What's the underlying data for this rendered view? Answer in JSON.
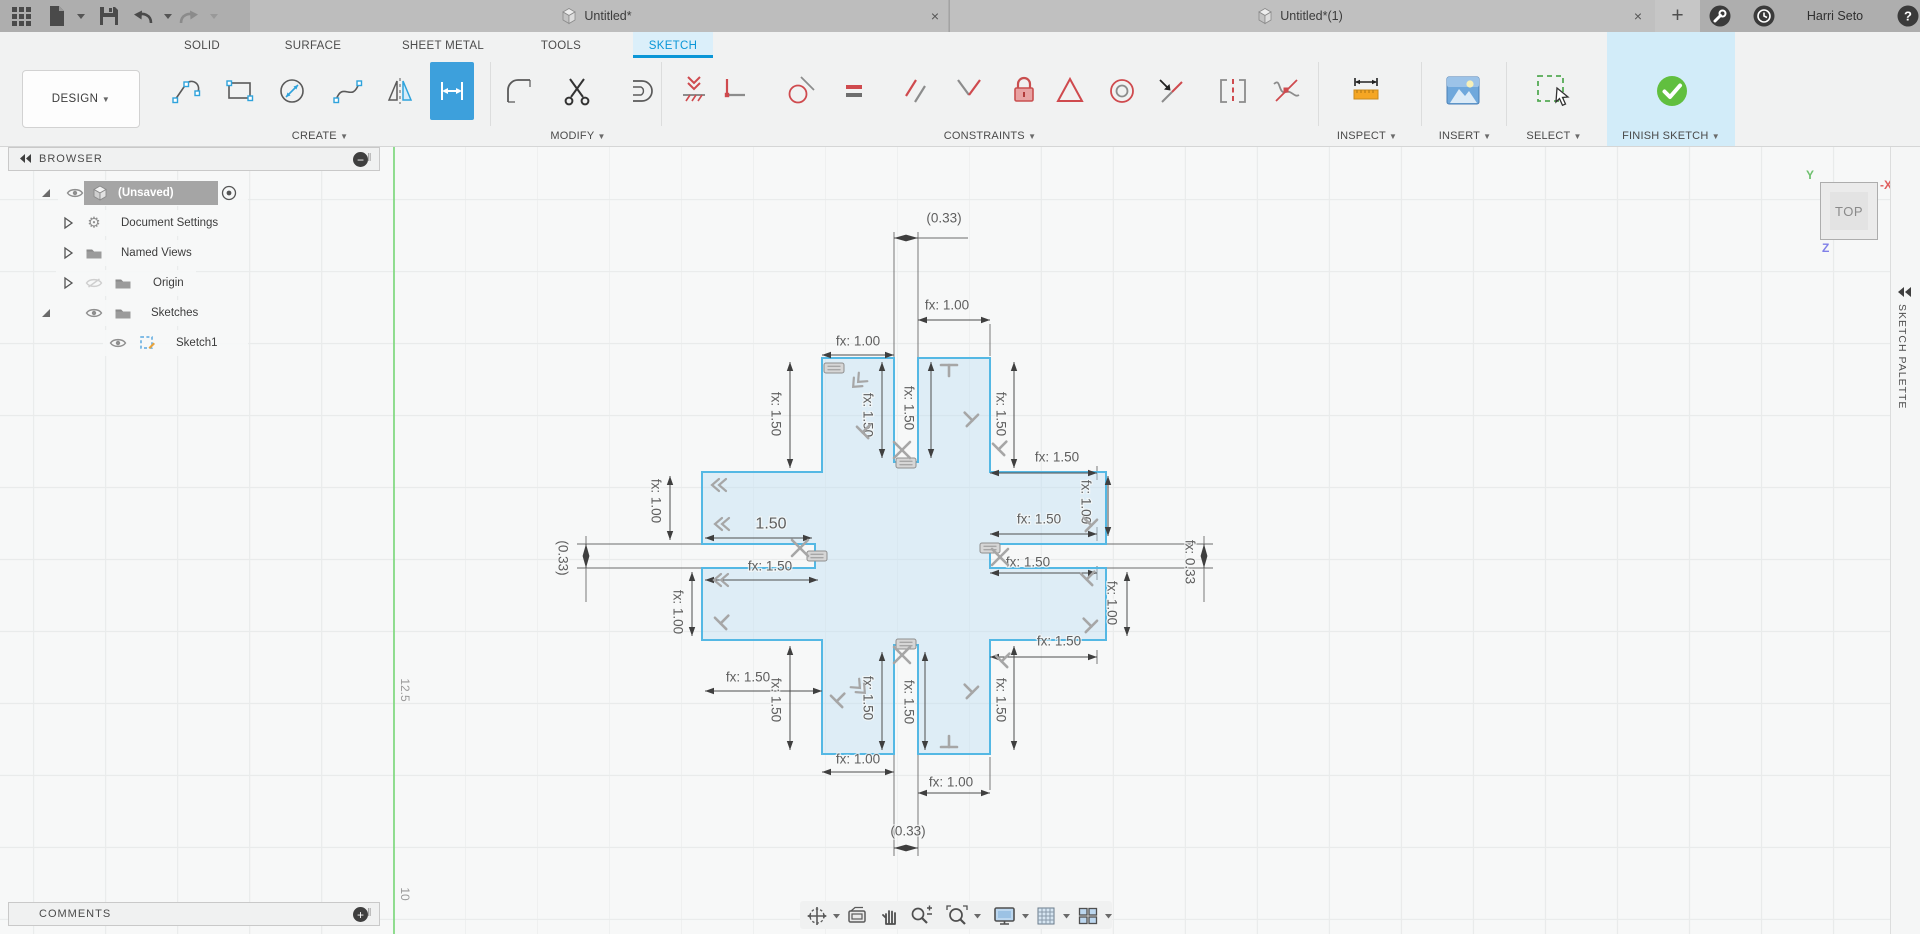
{
  "titlebar": {
    "tabs": [
      {
        "title": "Untitled*"
      },
      {
        "title": "Untitled*(1)"
      }
    ],
    "user": "Harri Seto",
    "actions": [
      "app-grid",
      "new-file",
      "save",
      "undo",
      "redo"
    ]
  },
  "ribbon": {
    "context_label": "DESIGN",
    "tabs": [
      "SOLID",
      "SURFACE",
      "SHEET METAL",
      "TOOLS",
      "SKETCH"
    ],
    "active_tab": "SKETCH",
    "groups": [
      {
        "label": "CREATE",
        "tools": [
          "line",
          "rectangle",
          "circle",
          "spline",
          "mirror",
          "sketch-dimension"
        ]
      },
      {
        "label": "MODIFY",
        "tools": [
          "fillet",
          "trim",
          "offset"
        ]
      },
      {
        "label": "CONSTRAINTS",
        "tools": [
          "coincident",
          "horizontal-vertical",
          "tangent",
          "equal",
          "parallel",
          "perpendicular",
          "fix-unfix",
          "symmetry",
          "concentric",
          "midpoint",
          "collinear",
          "curvature"
        ]
      },
      {
        "label": "INSPECT",
        "tools": [
          "measure"
        ]
      },
      {
        "label": "INSERT",
        "tools": [
          "insert-image"
        ]
      },
      {
        "label": "SELECT",
        "tools": [
          "select"
        ]
      },
      {
        "label": "FINISH SKETCH",
        "tools": [
          "finish-sketch"
        ]
      }
    ],
    "active_tool": "sketch-dimension"
  },
  "browser": {
    "header": "BROWSER",
    "comments_label": "COMMENTS",
    "rows": [
      {
        "label": "(Unsaved)",
        "icon": "cube",
        "expander": "open",
        "visibility": "visible",
        "selected": true,
        "activate_radio": true
      },
      {
        "label": "Document Settings",
        "icon": "gear",
        "expander": "closed"
      },
      {
        "label": "Named Views",
        "icon": "folder",
        "expander": "closed"
      },
      {
        "label": "Origin",
        "icon": "folder",
        "expander": "closed",
        "visibility": "hidden"
      },
      {
        "label": "Sketches",
        "icon": "folder",
        "expander": "open",
        "visibility": "visible"
      },
      {
        "label": "Sketch1",
        "icon": "sketch",
        "visibility": "visible",
        "indent": 2
      }
    ]
  },
  "canvas": {
    "viewcube_face": "TOP",
    "axis_labels": {
      "y": "Y",
      "x": "-X",
      "z": "Z"
    },
    "axis_colors": {
      "y": "#6ec06e",
      "x": "#e05c5c",
      "z": "#8080e8"
    },
    "scale_labels": [
      {
        "text": "12.5",
        "x": 404,
        "y": 691
      },
      {
        "text": "10",
        "x": 404,
        "y": 895
      }
    ],
    "palette_label": "SKETCH PALETTE",
    "sketch": {
      "stroke": "#54b8e4",
      "fill": "rgba(186,221,243,0.40)",
      "outline": [
        [
          822,
          358
        ],
        [
          894,
          358
        ],
        [
          894,
          462
        ],
        [
          918,
          462
        ],
        [
          918,
          358
        ],
        [
          990,
          358
        ],
        [
          990,
          472
        ],
        [
          1106,
          472
        ],
        [
          1106,
          544
        ],
        [
          990,
          544
        ],
        [
          990,
          568
        ],
        [
          1106,
          568
        ],
        [
          1106,
          640
        ],
        [
          990,
          640
        ],
        [
          990,
          754
        ],
        [
          918,
          754
        ],
        [
          918,
          645
        ],
        [
          894,
          645
        ],
        [
          894,
          754
        ],
        [
          822,
          754
        ],
        [
          822,
          640
        ],
        [
          702,
          640
        ],
        [
          702,
          568
        ],
        [
          815,
          568
        ],
        [
          815,
          544
        ],
        [
          702,
          544
        ],
        [
          702,
          472
        ],
        [
          822,
          472
        ]
      ],
      "extension_lines": [
        [
          894,
          232,
          894,
          358
        ],
        [
          918,
          232,
          918,
          358
        ],
        [
          918,
          238,
          968,
          238
        ],
        [
          894,
          754,
          894,
          856
        ],
        [
          918,
          754,
          918,
          856
        ],
        [
          577,
          544,
          702,
          544
        ],
        [
          577,
          568,
          702,
          568
        ],
        [
          1106,
          544,
          1213,
          544
        ],
        [
          1106,
          568,
          1213,
          568
        ],
        [
          586,
          536,
          586,
          602
        ],
        [
          1204,
          536,
          1204,
          602
        ],
        [
          990,
          324,
          990,
          356
        ],
        [
          990,
          757,
          990,
          790
        ],
        [
          1097,
          466,
          1097,
          480
        ],
        [
          1097,
          527,
          1097,
          541
        ],
        [
          1097,
          566,
          1097,
          580
        ],
        [
          1097,
          650,
          1097,
          664
        ]
      ],
      "dimensions": [
        {
          "label": "(0.33)",
          "tx": 944,
          "ty": 218,
          "rot": 0,
          "dir": "h",
          "pos": 238,
          "a": 894,
          "b": 918,
          "between": true
        },
        {
          "label": "fx: 1.00",
          "tx": 947,
          "ty": 305,
          "rot": 0,
          "dir": "h",
          "pos": 320,
          "a": 918,
          "b": 990
        },
        {
          "label": "fx: 1.00",
          "tx": 858,
          "ty": 341,
          "rot": 0,
          "dir": "h",
          "pos": 355,
          "a": 822,
          "b": 894
        },
        {
          "label": "fx: 1.50",
          "tx": 776,
          "ty": 414,
          "rot": 90,
          "dir": "v",
          "pos": 790,
          "a": 362,
          "b": 468
        },
        {
          "label": "fx: 1.50",
          "tx": 868,
          "ty": 415,
          "rot": 90,
          "dir": "v",
          "pos": 882,
          "a": 362,
          "b": 458
        },
        {
          "label": "fx: 1.50",
          "tx": 909,
          "ty": 408,
          "rot": 90,
          "dir": "v",
          "pos": 931,
          "a": 362,
          "b": 458
        },
        {
          "label": "fx: 1.50",
          "tx": 1001,
          "ty": 414,
          "rot": 90,
          "dir": "v",
          "pos": 1014,
          "a": 362,
          "b": 468
        },
        {
          "label": "fx: 1.50",
          "tx": 1057,
          "ty": 457,
          "rot": 0,
          "dir": "h",
          "pos": 473,
          "a": 990,
          "b": 1097
        },
        {
          "label": "fx: 1.50",
          "tx": 1039,
          "ty": 519,
          "rot": 0,
          "dir": "h",
          "pos": 534,
          "a": 990,
          "b": 1097
        },
        {
          "label": "fx: 1.50",
          "tx": 1028,
          "ty": 562,
          "rot": 0,
          "dir": "h",
          "pos": 573,
          "a": 990,
          "b": 1097
        },
        {
          "label": "fx: 1.50",
          "tx": 1059,
          "ty": 641,
          "rot": 0,
          "dir": "h",
          "pos": 657,
          "a": 990,
          "b": 1097
        },
        {
          "label": "fx: 1.00",
          "tx": 1086,
          "ty": 502,
          "rot": 90,
          "dir": "v",
          "pos": 1108,
          "a": 476,
          "b": 536
        },
        {
          "label": "fx: 1.00",
          "tx": 1112,
          "ty": 603,
          "rot": 90,
          "dir": "v",
          "pos": 1127,
          "a": 572,
          "b": 636
        },
        {
          "label": "fx: 0.33",
          "tx": 1190,
          "ty": 562,
          "rot": 90,
          "dir": "v",
          "pos": 1204,
          "a": 544,
          "b": 568,
          "between": true
        },
        {
          "label": "1.50",
          "tx": 771,
          "ty": 524,
          "rot": 0,
          "dir": "h",
          "pos": 538,
          "a": 705,
          "b": 812,
          "big": true
        },
        {
          "label": "fx: 1.50",
          "tx": 770,
          "ty": 566,
          "rot": 0,
          "dir": "h",
          "pos": 580,
          "a": 705,
          "b": 818
        },
        {
          "label": "fx: 1.00",
          "tx": 656,
          "ty": 501,
          "rot": 90,
          "dir": "v",
          "pos": 670,
          "a": 476,
          "b": 540
        },
        {
          "label": "fx: 1.00",
          "tx": 678,
          "ty": 612,
          "rot": 90,
          "dir": "v",
          "pos": 692,
          "a": 572,
          "b": 636
        },
        {
          "label": "(0.33)",
          "tx": 563,
          "ty": 558,
          "rot": 90,
          "dir": "v",
          "pos": 586,
          "a": 544,
          "b": 568,
          "between": true
        },
        {
          "label": "fx: 1.50",
          "tx": 748,
          "ty": 677,
          "rot": 0,
          "dir": "h",
          "pos": 691,
          "a": 705,
          "b": 822
        },
        {
          "label": "fx: 1.50",
          "tx": 776,
          "ty": 700,
          "rot": 90,
          "dir": "v",
          "pos": 790,
          "a": 646,
          "b": 750
        },
        {
          "label": "fx: 1.50",
          "tx": 868,
          "ty": 698,
          "rot": 90,
          "dir": "v",
          "pos": 882,
          "a": 652,
          "b": 750
        },
        {
          "label": "fx: 1.50",
          "tx": 909,
          "ty": 702,
          "rot": 90,
          "dir": "v",
          "pos": 925,
          "a": 652,
          "b": 750
        },
        {
          "label": "fx: 1.50",
          "tx": 1001,
          "ty": 700,
          "rot": 90,
          "dir": "v",
          "pos": 1014,
          "a": 646,
          "b": 750
        },
        {
          "label": "fx: 1.00",
          "tx": 858,
          "ty": 759,
          "rot": 0,
          "dir": "h",
          "pos": 772,
          "a": 822,
          "b": 894
        },
        {
          "label": "fx: 1.00",
          "tx": 951,
          "ty": 782,
          "rot": 0,
          "dir": "h",
          "pos": 793,
          "a": 918,
          "b": 990
        },
        {
          "label": "(0.33)",
          "tx": 908,
          "ty": 831,
          "rot": 0,
          "dir": "h",
          "pos": 848,
          "a": 894,
          "b": 918,
          "between": true
        }
      ],
      "constraint_glyphs": [
        [
          "eq",
          834,
          368,
          0
        ],
        [
          "eq",
          906,
          463,
          0
        ],
        [
          "eq",
          817,
          556,
          0
        ],
        [
          "eq",
          990,
          548,
          0
        ],
        [
          "eq",
          906,
          644,
          0
        ],
        [
          "x",
          902,
          450,
          0
        ],
        [
          "x",
          800,
          548,
          0
        ],
        [
          "x",
          1000,
          557,
          0
        ],
        [
          "x",
          902,
          655,
          0
        ],
        [
          "chev",
          856,
          384,
          -45
        ],
        [
          "chev",
          716,
          485,
          0
        ],
        [
          "chev",
          719,
          524,
          0
        ],
        [
          "chev",
          718,
          580,
          0
        ],
        [
          "chev",
          862,
          690,
          -135
        ],
        [
          "perp",
          971,
          419,
          -45
        ],
        [
          "perp",
          864,
          431,
          45
        ],
        [
          "perp",
          722,
          622,
          45
        ],
        [
          "perp",
          1000,
          448,
          45
        ],
        [
          "perp",
          1090,
          524,
          -45
        ],
        [
          "perp",
          1088,
          578,
          45
        ],
        [
          "perp",
          1090,
          625,
          -45
        ],
        [
          "perp",
          1003,
          660,
          45
        ],
        [
          "perp",
          838,
          700,
          45
        ],
        [
          "perp",
          971,
          691,
          -45
        ],
        [
          "tee",
          949,
          367,
          0
        ],
        [
          "tee",
          949,
          745,
          180
        ]
      ]
    },
    "navbar_tools": [
      "orbit",
      "look-at",
      "pan",
      "zoom",
      "fit",
      "display-settings",
      "grid-settings",
      "viewports"
    ]
  }
}
